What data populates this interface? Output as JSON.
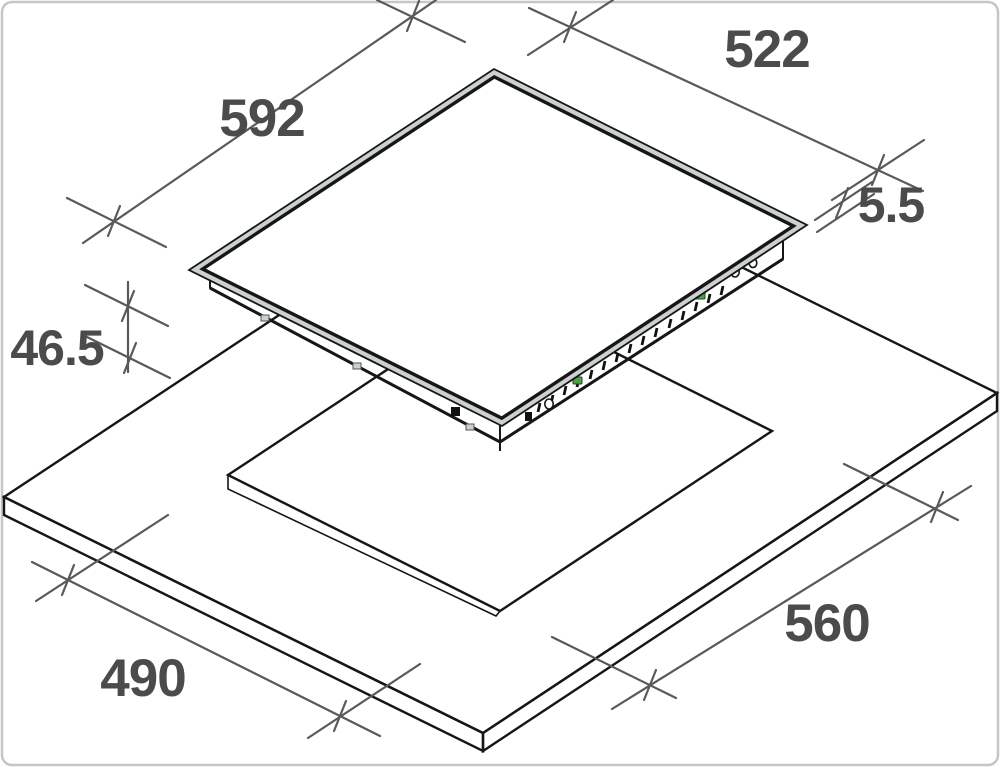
{
  "drawing": {
    "title": "cooktop-installation-dimensions",
    "unit": "mm",
    "dimensions": {
      "glass_width": "592",
      "glass_depth": "522",
      "glass_edge_thickness": "5.5",
      "body_height": "46.5",
      "cutout_depth": "490",
      "cutout_width": "560"
    },
    "colors": {
      "line": "#161616",
      "dimension_line": "#595959",
      "label_text": "#4b4b4d",
      "glass_rim": "#cbd0d0",
      "mounting_clip_green": "#4ba24b",
      "background": "#ffffff",
      "frame": "#c6c6c6"
    }
  }
}
